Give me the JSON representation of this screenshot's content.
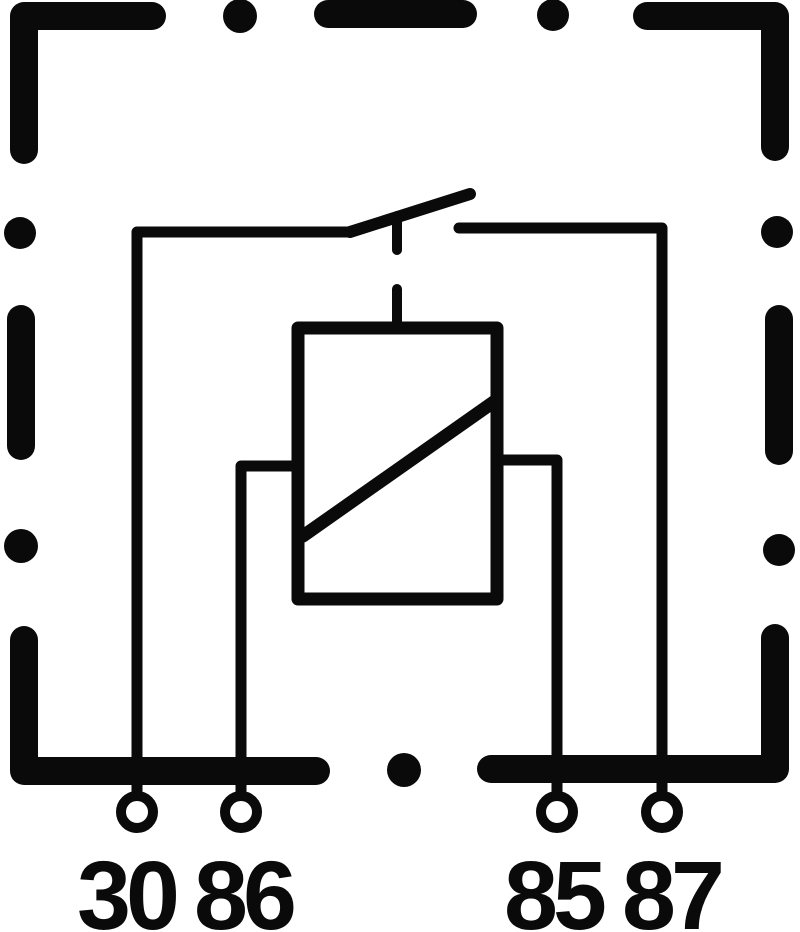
{
  "colors": {
    "line": "#0a0a0a",
    "background": "#ffffff"
  },
  "terminals": [
    {
      "id": "30",
      "label": "30"
    },
    {
      "id": "86",
      "label": "86"
    },
    {
      "id": "85",
      "label": "85"
    },
    {
      "id": "87",
      "label": "87"
    }
  ]
}
